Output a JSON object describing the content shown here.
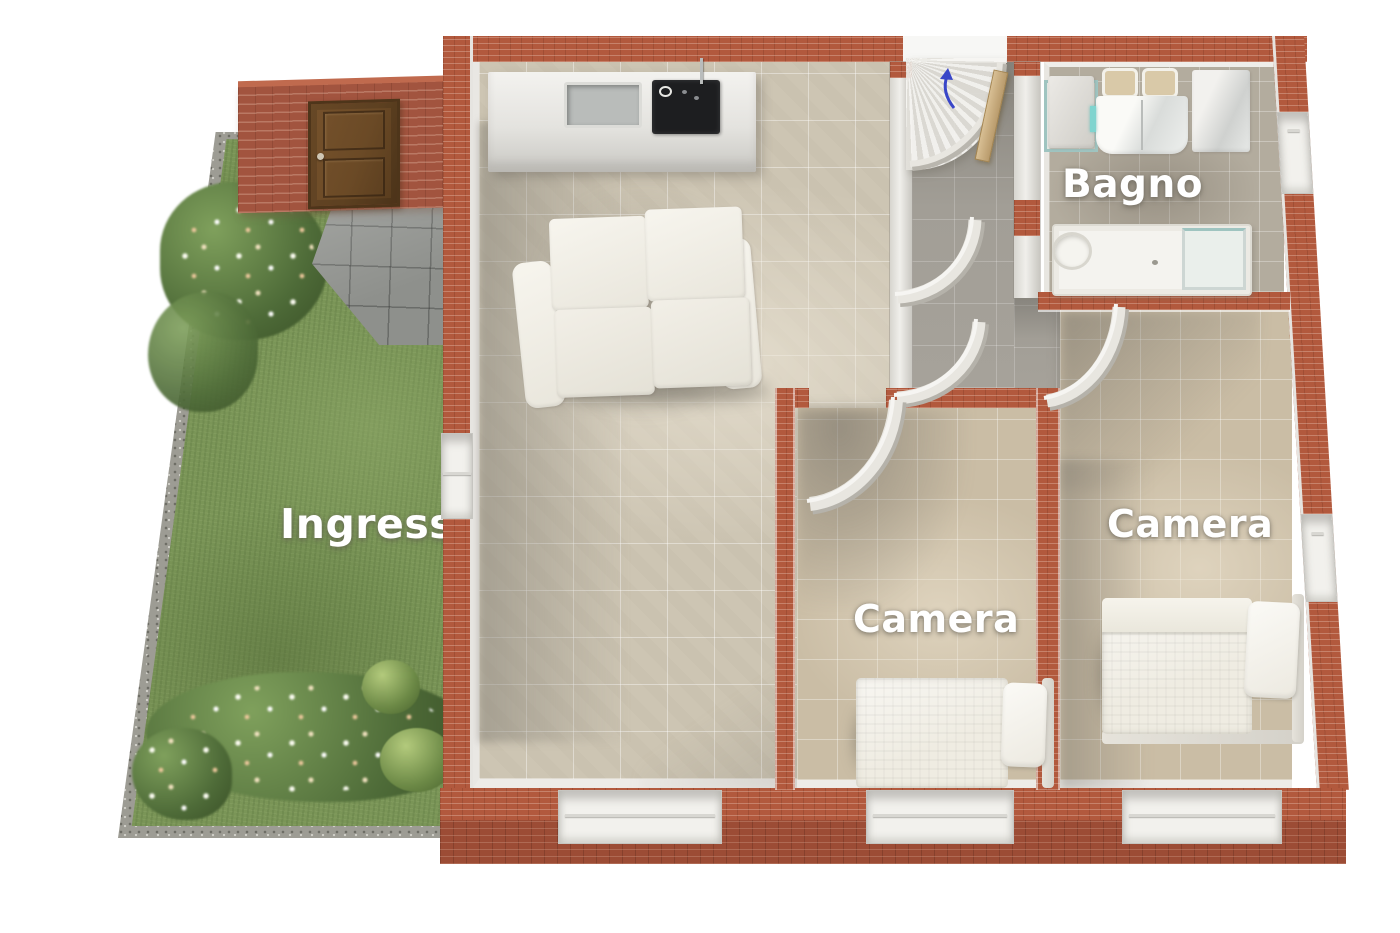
{
  "scene": {
    "type": "3d-floorplan-render",
    "description": "Isometric cutaway render of a small apartment with entry garden"
  },
  "labels": {
    "ingresso": "Ingresso",
    "bagno": "Bagno",
    "camera_middle": "Camera",
    "camera_right": "Camera"
  },
  "colors": {
    "background": "#ffffff",
    "brick_wall_top": "#b2593d",
    "brick_wall_face": "#a2543f",
    "brick_wall_dark": "#9c4c35",
    "wood_entry_door": "#6d4a26",
    "grass_green": "#7a9557",
    "gravel_border": "#9d9c94",
    "stone_path_grey": "#8e908c",
    "living_floor_beige": "#cdc5b3",
    "bedroom_floor_beige": "#cabda5",
    "bathroom_floor_grey": "#b3ac9e",
    "hallway_floor_grey": "#a6a29a",
    "interior_wall_white": "#eceae6",
    "furniture_white": "#f2f0e9",
    "cooktop_black": "#1d1e20",
    "label_text_white": "#ffffff",
    "entrance_arrow_blue": "#3946c8",
    "shower_glass_teal": "#9fc4c0"
  }
}
